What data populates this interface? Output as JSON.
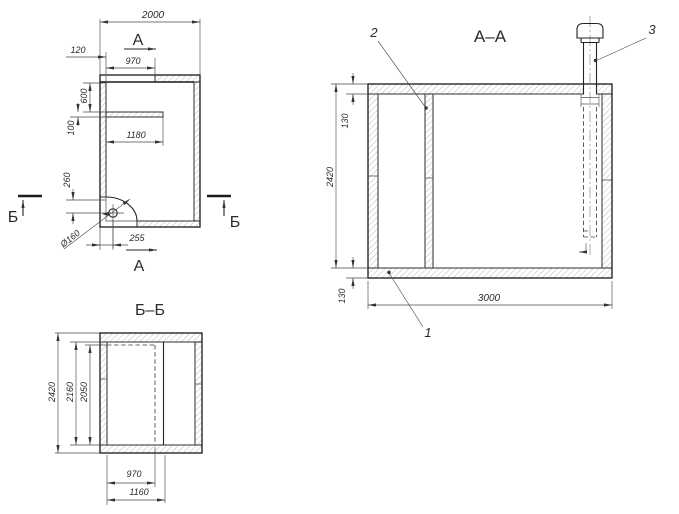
{
  "plan": {
    "section_a_top": "А",
    "section_a_bottom": "А",
    "section_b_left": "Б",
    "section_b_right": "Б",
    "dims": {
      "overall_width": "2000",
      "wall_offset": "120",
      "opening_width": "970",
      "recess_depth": "600",
      "partition_thickness": "100",
      "partition_length": "1180",
      "hole_offset_y": "260",
      "hole_offset_x": "255",
      "hole_diameter": "Ø160"
    }
  },
  "section_aa": {
    "title": "А–А",
    "dims": {
      "height": "2420",
      "ceiling_thickness": "130",
      "floor_thickness": "130",
      "length": "3000"
    },
    "callout_1": "1",
    "callout_2": "2",
    "callout_3": "3"
  },
  "section_bb": {
    "title": "Б–Б",
    "dims": {
      "height": "2420",
      "inner_height": "2160",
      "opening_height": "2050",
      "opening_width": "970",
      "partition_span": "1160"
    }
  }
}
